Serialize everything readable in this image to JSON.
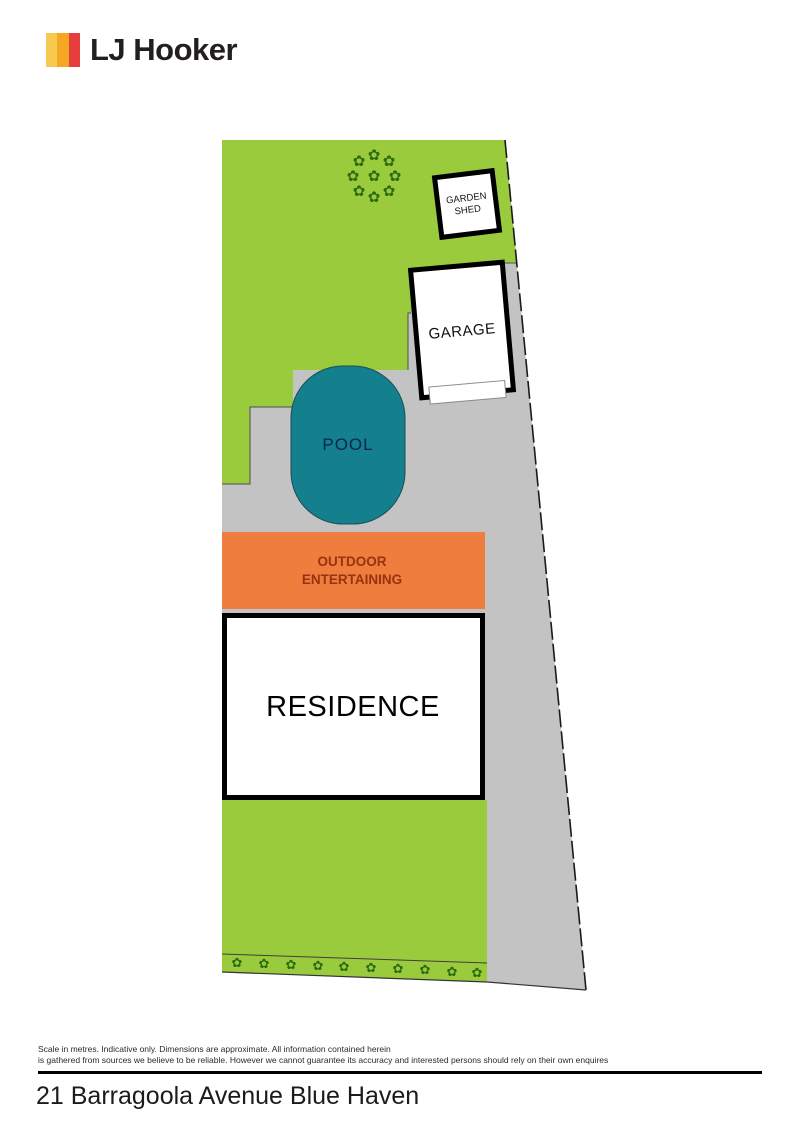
{
  "logo": {
    "brand": "LJ Hooker",
    "stripe_colors": [
      "#F6C94F",
      "#F5A623",
      "#E83D3D"
    ]
  },
  "plan": {
    "labels": {
      "garden_shed_line1": "GARDEN",
      "garden_shed_line2": "SHED",
      "garage": "GARAGE",
      "pool": "POOL",
      "outdoor_line1": "OUTDOOR",
      "outdoor_line2": "ENTERTAINING",
      "residence": "RESIDENCE"
    },
    "icons": {
      "flower_glyph": "✿",
      "tree_flower_glyph": "✿"
    },
    "colors": {
      "grass": "#9ACB3D",
      "paving": "#C3C3C4",
      "pool_water": "#15808D",
      "pool_text": "#0D2257",
      "outdoor_fill": "#EF7D3E",
      "outdoor_text": "#99320F",
      "structure_outline": "#000000",
      "flower": "#2C6B12"
    }
  },
  "footer": {
    "disclaimer_line1": "Scale in metres. Indicative only. Dimensions are approximate. All information contained herein",
    "disclaimer_line2": "is gathered from sources we believe to be reliable. However we cannot guarantee its accuracy and interested persons should rely on their own enquires",
    "address": "21 Barragoola Avenue Blue Haven"
  }
}
